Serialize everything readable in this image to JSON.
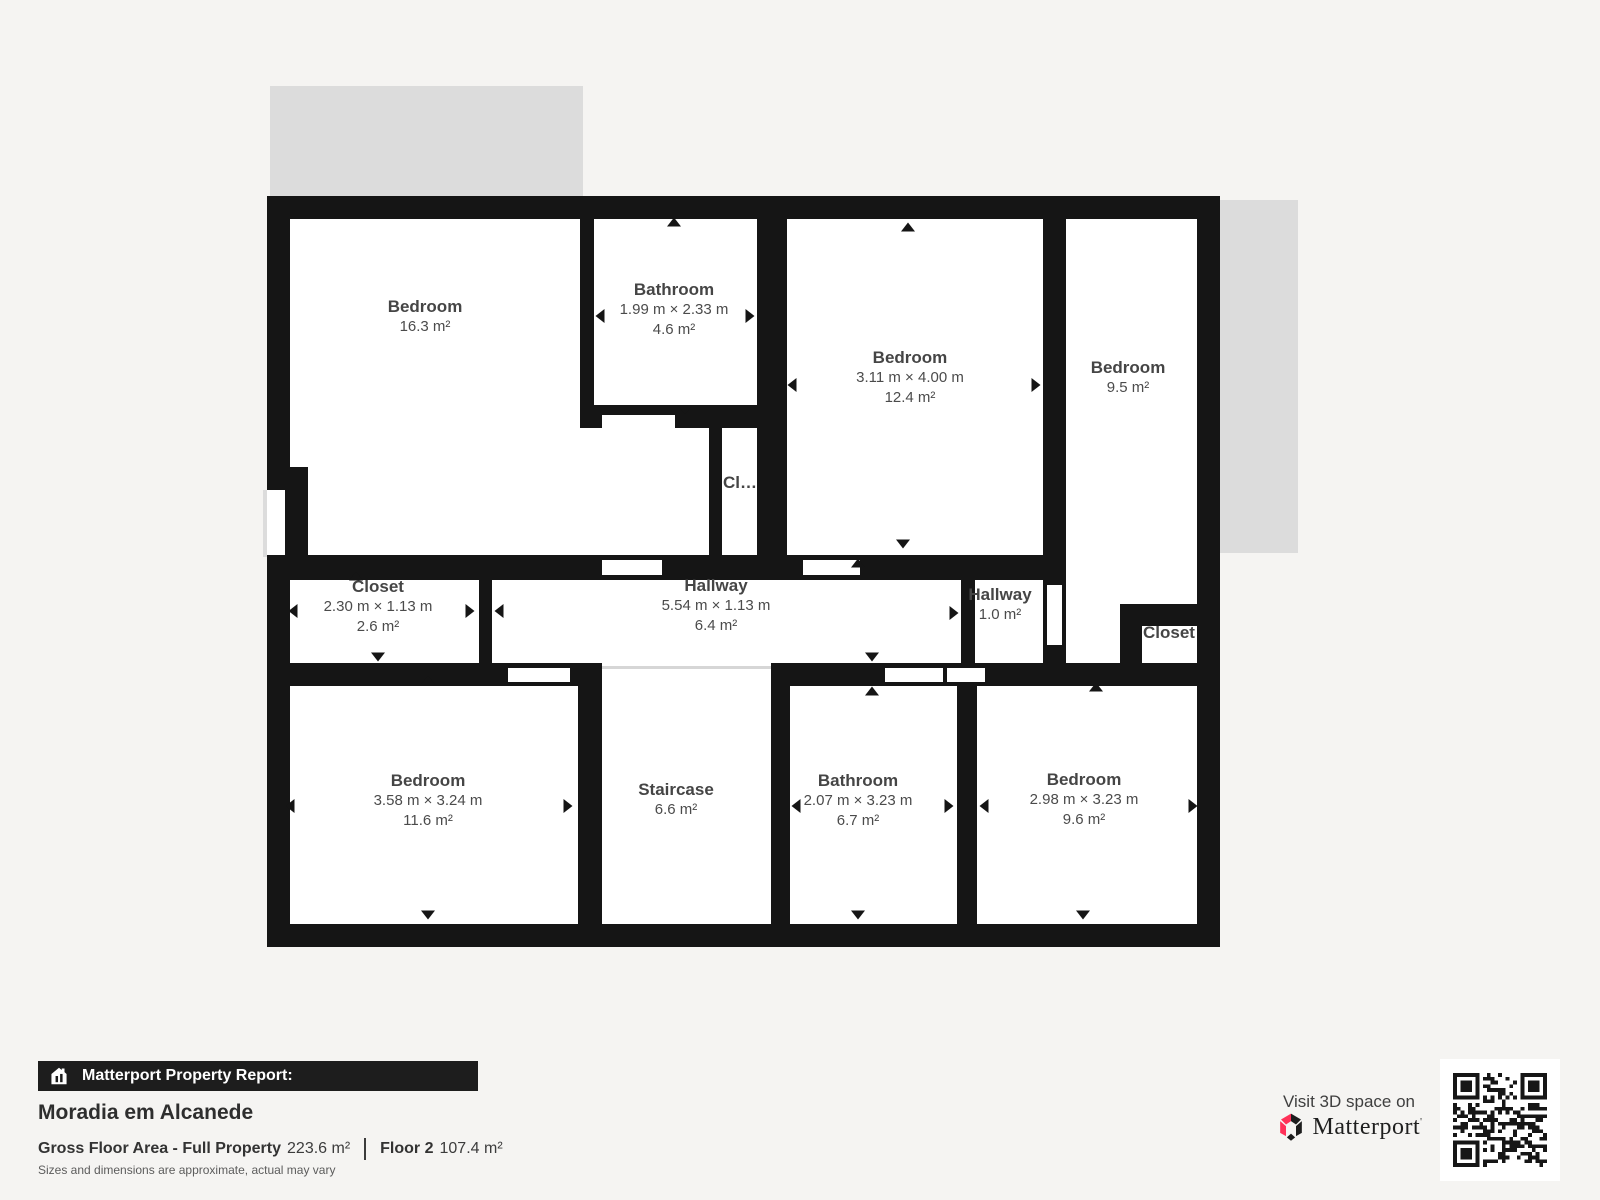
{
  "plan": {
    "rooms": [
      {
        "name": "Bedroom",
        "dims": "",
        "area": "16.3 m²"
      },
      {
        "name": "Bathroom",
        "dims": "1.99 m × 2.33 m",
        "area": "4.6 m²"
      },
      {
        "name": "Bedroom",
        "dims": "3.11 m × 4.00 m",
        "area": "12.4 m²"
      },
      {
        "name": "Bedroom",
        "dims": "",
        "area": "9.5 m²"
      },
      {
        "name": "Cl…",
        "dims": "",
        "area": ""
      },
      {
        "name": "Closet",
        "dims": "2.30 m × 1.13 m",
        "area": "2.6 m²"
      },
      {
        "name": "Hallway",
        "dims": "5.54 m × 1.13 m",
        "area": "6.4 m²"
      },
      {
        "name": "Hallway",
        "dims": "",
        "area": "1.0 m²"
      },
      {
        "name": "Closet",
        "dims": "",
        "area": ""
      },
      {
        "name": "Bedroom",
        "dims": "3.58 m × 3.24 m",
        "area": "11.6 m²"
      },
      {
        "name": "Staircase",
        "dims": "",
        "area": "6.6 m²"
      },
      {
        "name": "Bathroom",
        "dims": "2.07 m × 3.23 m",
        "area": "6.7 m²"
      },
      {
        "name": "Bedroom",
        "dims": "2.98 m × 3.23 m",
        "area": "9.6 m²"
      }
    ]
  },
  "footer": {
    "report_label": "Matterport Property Report:",
    "property_name": "Moradia em Alcanede",
    "gross_label": "Gross Floor Area - Full Property",
    "gross_value": "223.6 m²",
    "floor_label": "Floor 2",
    "floor_value": "107.4 m²",
    "disclaimer": "Sizes and dimensions are approximate, actual may vary",
    "visit_text": "Visit 3D space on",
    "brand": "Matterport"
  },
  "colors": {
    "wall": "#151515",
    "accent_red": "#ff3158",
    "gray_area": "#dcdcdc",
    "background": "#f5f4f2"
  }
}
